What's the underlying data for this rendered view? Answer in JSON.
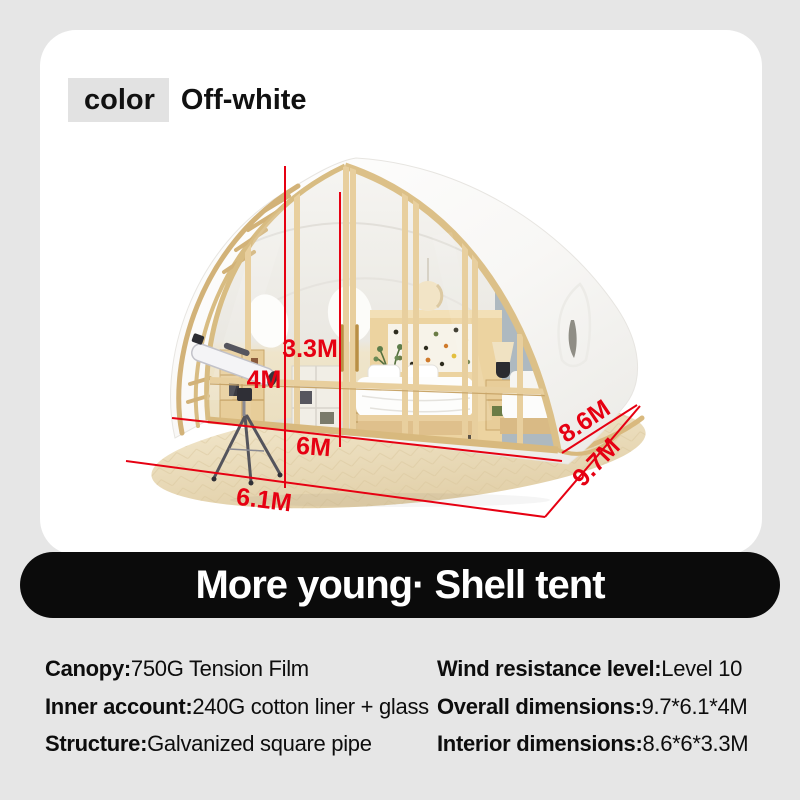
{
  "page": {
    "background": "#e6e6e6",
    "card_background": "#ffffff"
  },
  "color_selector": {
    "label": "color",
    "value": "Off-white"
  },
  "banner": {
    "title": "More young· Shell tent",
    "background": "#0b0b0b",
    "text_color": "#ffffff"
  },
  "specs": {
    "left": [
      {
        "label": "Canopy:",
        "value": "750G Tension Film"
      },
      {
        "label": "Inner account:",
        "value": "240G cotton liner + glass"
      },
      {
        "label": "Structure:",
        "value": "Galvanized square pipe"
      }
    ],
    "right": [
      {
        "label": "Wind resistance level:",
        "value": "Level 10"
      },
      {
        "label": "Overall dimensions:",
        "value": "9.7*6.1*4M"
      },
      {
        "label": "Interior dimensions:",
        "value": "8.6*6*3.3M"
      }
    ]
  },
  "dimensions": {
    "overall_height": "4M",
    "interior_height": "3.3M",
    "front_width": "6M",
    "base_width": "6.1M",
    "side_length": "8.6M",
    "base_depth": "9.7M",
    "accent_color": "#e60012"
  },
  "tent": {
    "shell_color": "#fbfbfa",
    "frame_color": "#d9b97e",
    "deck_color": "#ecdfc0",
    "description": "shell-tent-with-glass-facade-bedroom-interior-and-telescope"
  }
}
